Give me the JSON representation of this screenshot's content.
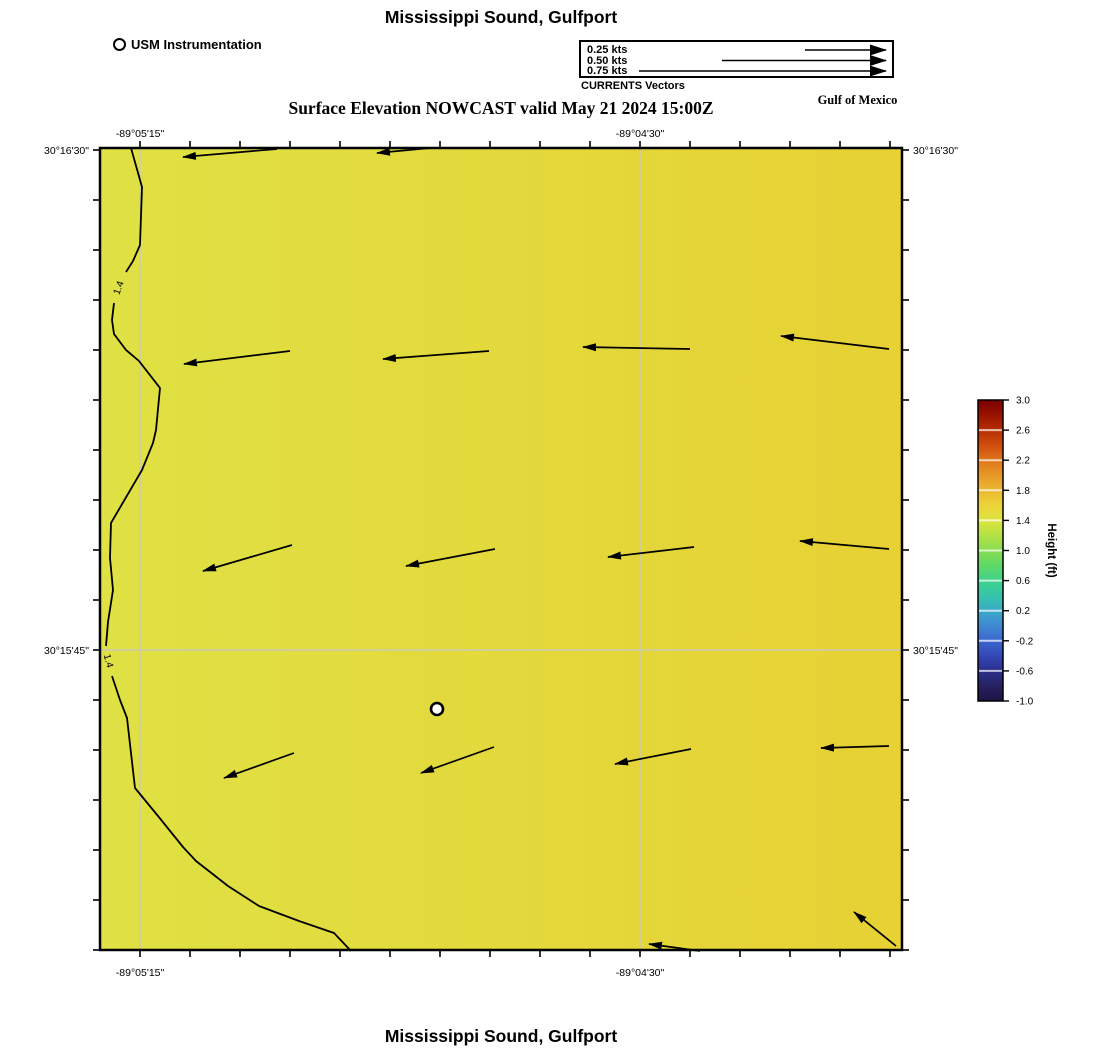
{
  "header": {
    "title": "Mississippi Sound, Gulfport",
    "subtitle": "Surface Elevation NOWCAST valid May 21 2024 15:00Z",
    "region_label": "Gulf of Mexico"
  },
  "footer": {
    "title": "Mississippi Sound, Gulfport"
  },
  "legend": {
    "usm": {
      "label": "USM Instrumentation"
    },
    "currents": {
      "caption": "CURRENTS Vectors",
      "entries": [
        {
          "label": "0.25 kts",
          "kts": 0.25
        },
        {
          "label": "0.50 kts",
          "kts": 0.5
        },
        {
          "label": "0.75 kts",
          "kts": 0.75
        }
      ]
    }
  },
  "chart_data": {
    "type": "map",
    "title": "Mississippi Sound, Gulfport",
    "subtitle": "Surface Elevation NOWCAST valid May 21 2024 15:00Z",
    "region_label": "Gulf of Mexico",
    "axes": {
      "lon": {
        "tick_labels": [
          "-89°05'15\"",
          "-89°04'30\""
        ],
        "tick_x_px": [
          140,
          640
        ]
      },
      "lat": {
        "tick_labels": [
          "30°16'30\"",
          "30°15'45\""
        ],
        "tick_y_px": [
          150,
          650
        ]
      }
    },
    "map_px": {
      "left": 100,
      "top": 148,
      "right": 902,
      "bottom": 950
    },
    "minor_ticks": {
      "x_start": 140,
      "x_end": 890,
      "y_start": 150,
      "y_end": 950,
      "step": 50
    },
    "grid_x_px": [
      140,
      640
    ],
    "grid_y_px": [
      650
    ],
    "grid_color": "#ccc9b6",
    "sea_fill": [
      "#dfe144",
      "#e7d134"
    ],
    "contour": {
      "label": "1.4",
      "stroke": "#000000",
      "segments": [
        [
          [
            131,
            148
          ],
          [
            142,
            187
          ],
          [
            140,
            245
          ],
          [
            133,
            261
          ],
          [
            126,
            272
          ]
        ],
        [
          [
            114,
            303
          ],
          [
            112,
            320
          ],
          [
            114,
            334
          ],
          [
            126,
            350
          ],
          [
            139,
            361
          ],
          [
            160,
            388
          ],
          [
            156,
            430
          ],
          [
            153,
            443
          ],
          [
            142,
            470
          ],
          [
            111,
            523
          ],
          [
            110,
            558
          ],
          [
            113,
            590
          ],
          [
            108,
            622
          ],
          [
            106,
            646
          ]
        ],
        [
          [
            112,
            676
          ],
          [
            120,
            700
          ],
          [
            127,
            718
          ],
          [
            135,
            788
          ],
          [
            158,
            816
          ],
          [
            183,
            847
          ],
          [
            196,
            861
          ],
          [
            228,
            886
          ],
          [
            259,
            906
          ],
          [
            299,
            921
          ],
          [
            334,
            933
          ],
          [
            351,
            951
          ]
        ]
      ],
      "labels": [
        {
          "x": 119,
          "y": 288,
          "angle": -70
        },
        {
          "x": 108,
          "y": 661,
          "angle": 75
        }
      ]
    },
    "current_vectors_px": [
      [
        277,
        149,
        183,
        157
      ],
      [
        430,
        148,
        377,
        153
      ],
      [
        290,
        351,
        184,
        364
      ],
      [
        489,
        351,
        383,
        359
      ],
      [
        690,
        349,
        583,
        347
      ],
      [
        889,
        349,
        781,
        336
      ],
      [
        292,
        545,
        203,
        571
      ],
      [
        495,
        549,
        406,
        566
      ],
      [
        694,
        547,
        608,
        557
      ],
      [
        889,
        549,
        800,
        541
      ],
      [
        294,
        753,
        224,
        778
      ],
      [
        494,
        747,
        421,
        773
      ],
      [
        691,
        749,
        615,
        764
      ],
      [
        889,
        746,
        821,
        748
      ],
      [
        700,
        951,
        649,
        944
      ],
      [
        896,
        946,
        854,
        912
      ]
    ],
    "station_marker_px": {
      "x": 437,
      "y": 709
    },
    "vector_scale": {
      "px_per_kt": 332,
      "legend_head_x_px": 888,
      "legend_row_y_px": [
        50,
        60.5,
        71
      ]
    },
    "colorbar": {
      "label": "Height (ft)",
      "min": -1.0,
      "max": 3.0,
      "tick_labels": [
        "3.0",
        "2.6",
        "2.2",
        "1.8",
        "1.4",
        "1.0",
        "0.6",
        "0.2",
        "-0.2",
        "-0.6",
        "-1.0"
      ],
      "x": 978,
      "y": 400,
      "width": 25,
      "height": 301,
      "gradient_bottom_to_top": [
        [
          "0",
          "#1d1345"
        ],
        [
          "0.05",
          "#27215f"
        ],
        [
          "0.1",
          "#2c2f8d"
        ],
        [
          "0.15",
          "#3347b5"
        ],
        [
          "0.2",
          "#3a66cd"
        ],
        [
          "0.25",
          "#3f88d2"
        ],
        [
          "0.3",
          "#3aaac6"
        ],
        [
          "0.35",
          "#36c4ab"
        ],
        [
          "0.4",
          "#3fd28a"
        ],
        [
          "0.45",
          "#5ed968"
        ],
        [
          "0.5",
          "#87dd50"
        ],
        [
          "0.55",
          "#b3e246"
        ],
        [
          "0.6",
          "#dde33f"
        ],
        [
          "0.65",
          "#ecd439"
        ],
        [
          "0.7",
          "#ecb732"
        ],
        [
          "0.75",
          "#e79928"
        ],
        [
          "0.8",
          "#df751b"
        ],
        [
          "0.85",
          "#d04d0d"
        ],
        [
          "0.9",
          "#b72e03"
        ],
        [
          "0.95",
          "#991300"
        ],
        [
          "1",
          "#7b0000"
        ]
      ]
    }
  }
}
